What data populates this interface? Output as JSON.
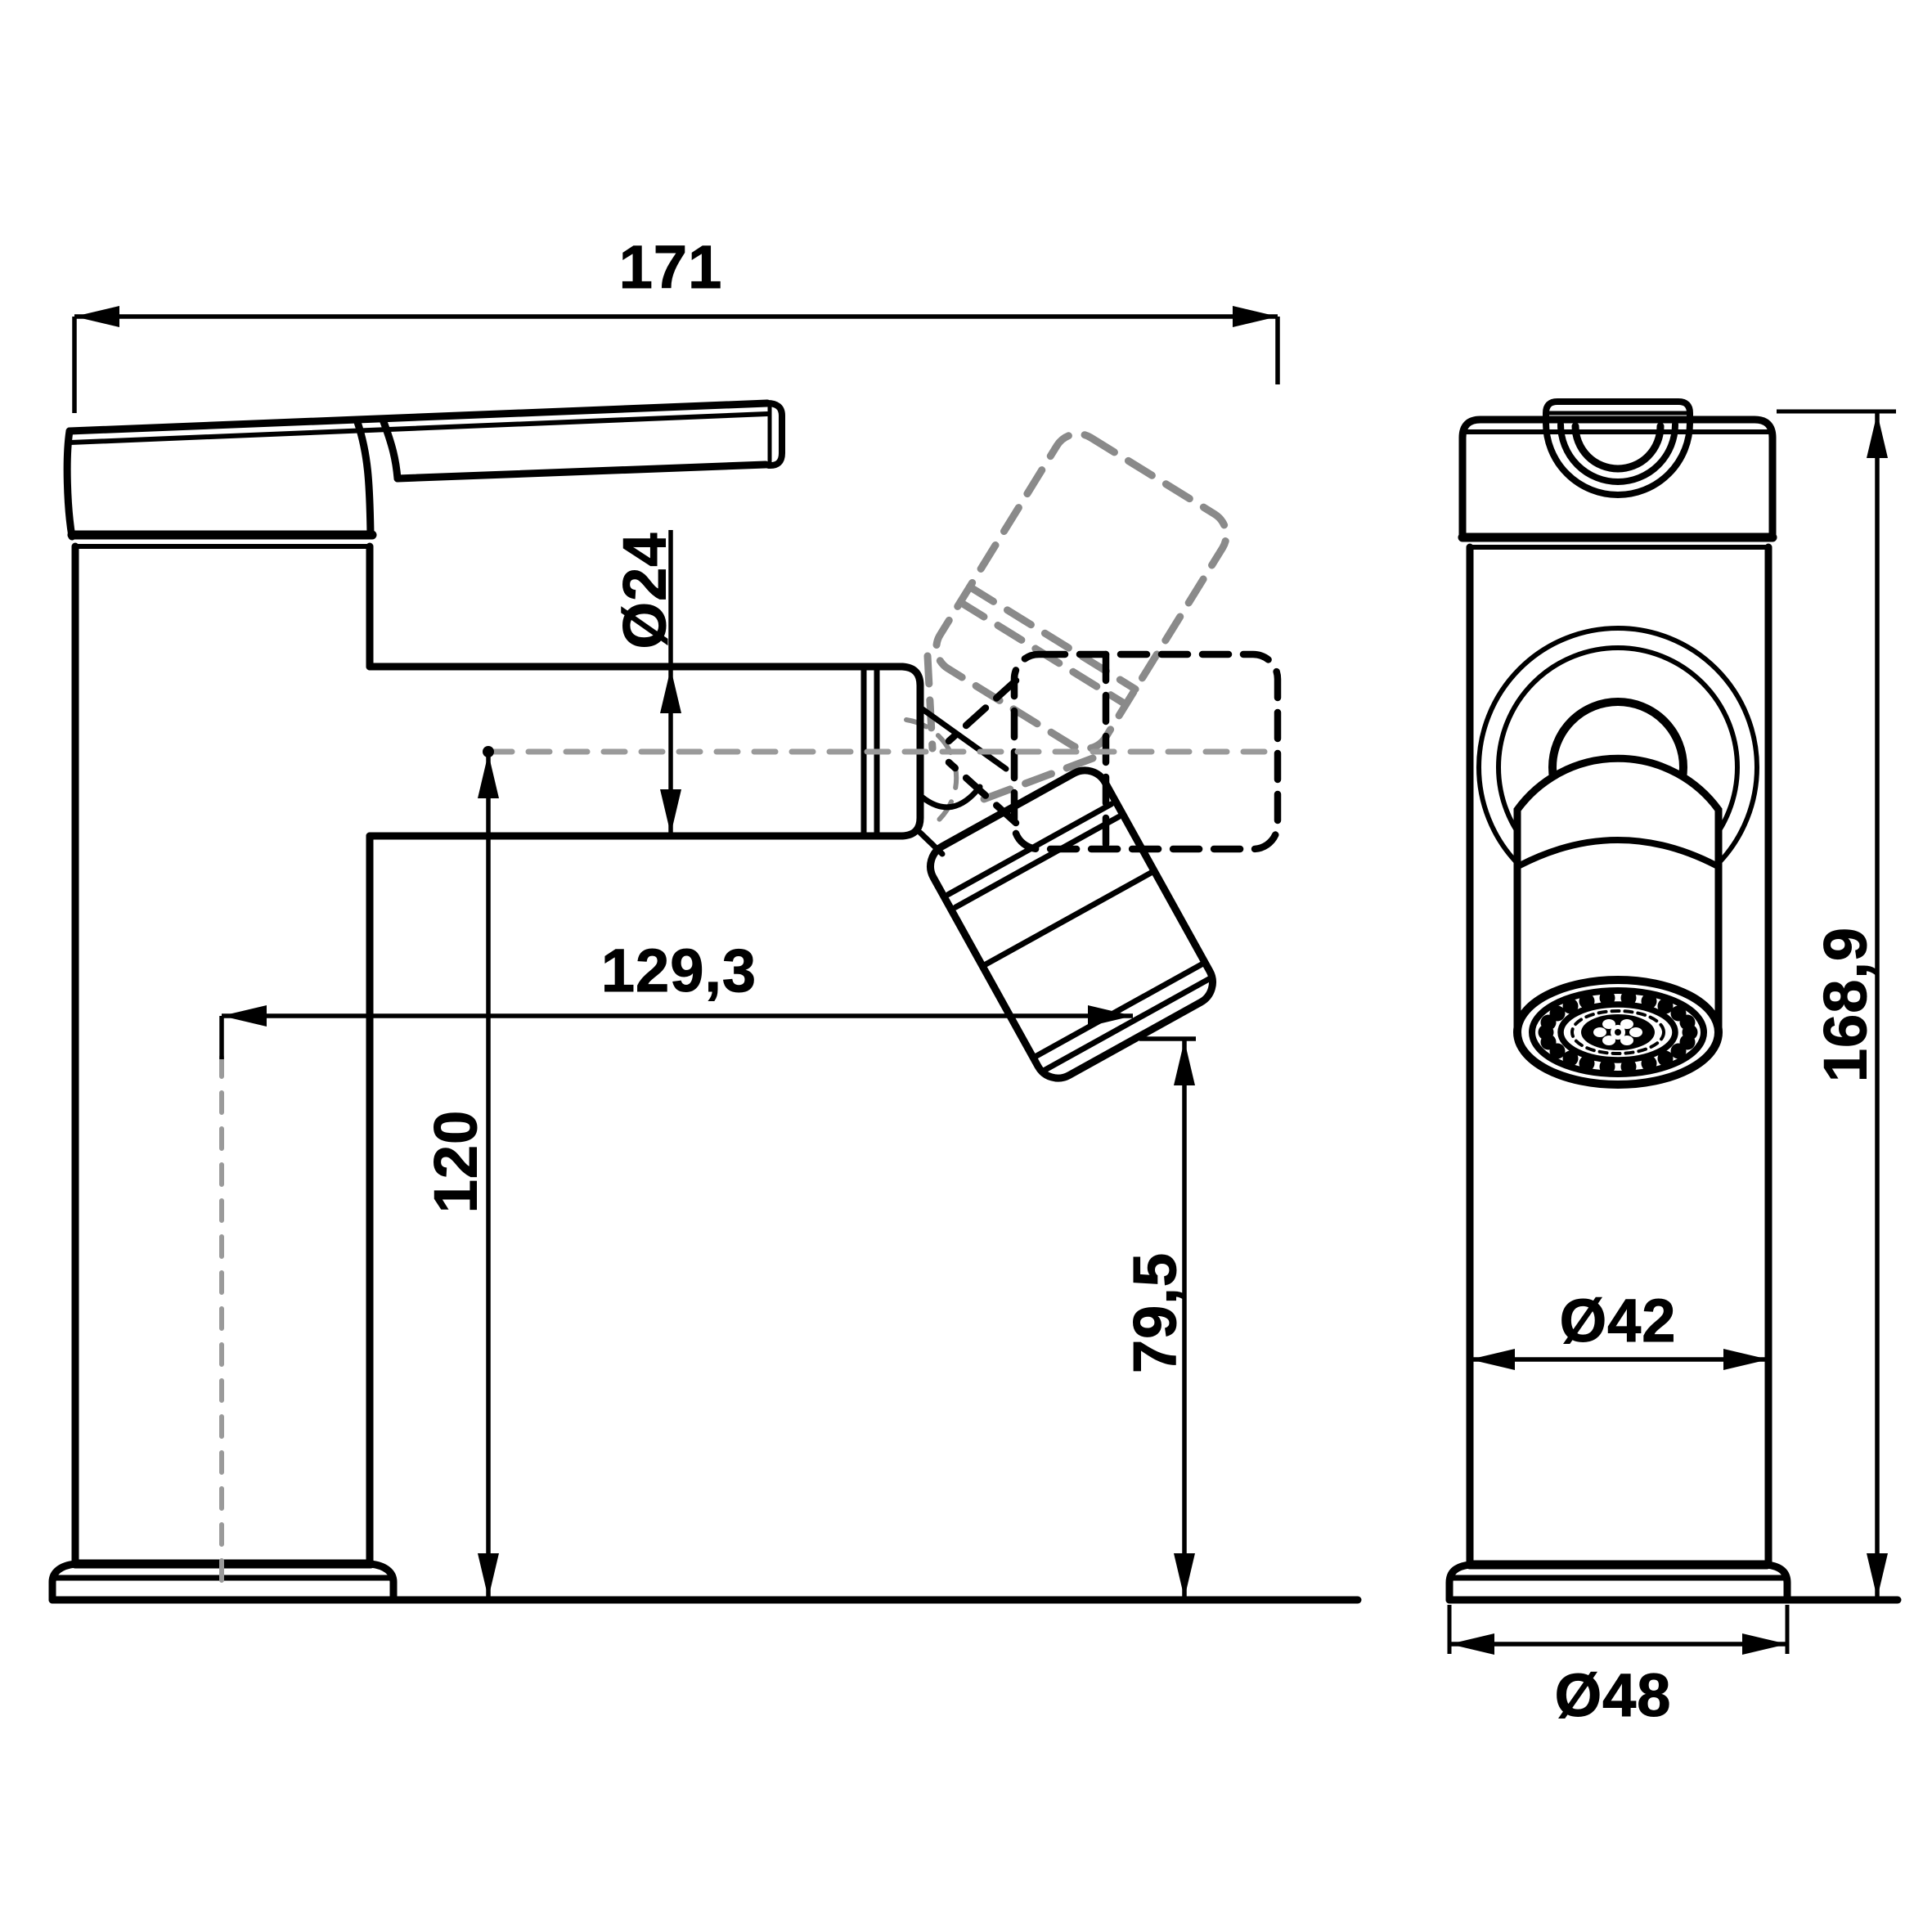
{
  "document": {
    "type": "technical-drawing",
    "subject": "single-lever bidet/basin mixer faucet, two orthographic views with dimensions",
    "background": "#ffffff",
    "line_color": "#000000",
    "ghost_position_color": "#8a8a8a",
    "centerline_color": "#9a9a9a"
  },
  "views": {
    "side_view": {
      "name": "side view with swivel spout positions"
    },
    "front_view": {
      "name": "front view with aerator detail"
    }
  },
  "dims": {
    "width_overall": {
      "label": "171",
      "meaning": "overall length incl. horizontal spout position (mm)"
    },
    "spout_diameter": {
      "label": "Ø24",
      "meaning": "spout tube diameter (mm)"
    },
    "spout_reach": {
      "label": "129,3",
      "meaning": "reach from body axis to outlet (mm)"
    },
    "spout_center_height": {
      "label": "120",
      "meaning": "height of spout axis above deck (mm)"
    },
    "outlet_height": {
      "label": "79,5",
      "meaning": "height of outlet above deck (mm)"
    },
    "total_height": {
      "label": "168,9",
      "meaning": "overall height (mm)"
    },
    "body_diameter": {
      "label": "Ø42",
      "meaning": "body diameter (mm)"
    },
    "base_diameter": {
      "label": "Ø48",
      "meaning": "base diameter (mm)"
    }
  }
}
